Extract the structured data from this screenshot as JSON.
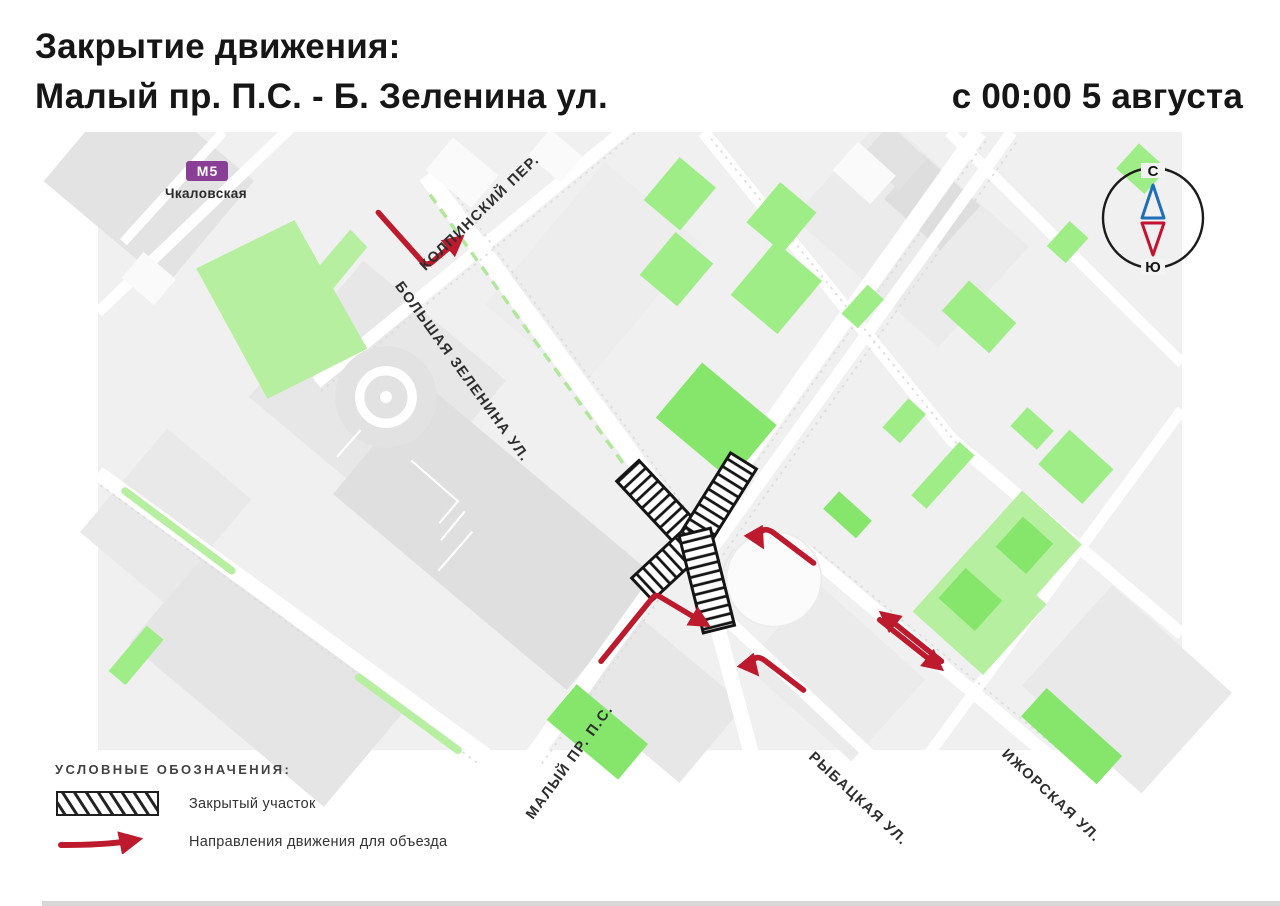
{
  "title": {
    "line1": "Закрытие движения:",
    "line2": "Малый пр. П.С. - Б. Зеленина ул.",
    "datetime": "с 00:00 5 августа"
  },
  "metro": {
    "logo": "М",
    "line_number": "5",
    "station": "Чкаловская"
  },
  "compass": {
    "north_label": "С",
    "south_label": "Ю"
  },
  "street_labels": {
    "kolpinsky": "КОЛПИНСКИЙ ПЕР.",
    "zelenina": "БОЛЬШАЯ ЗЕЛЕНИНА УЛ.",
    "maly": "МАЛЫЙ ПР. П.С.",
    "rybatskaya": "РЫБАЦКАЯ УЛ.",
    "izhorskaya": "ИЖОРСКАЯ УЛ."
  },
  "legend": {
    "header": "УСЛОВНЫЕ ОБОЗНАЧЕНИЯ:",
    "closed_label": "Закрытый участок",
    "detour_label": "Направления движения для объезда"
  },
  "colors": {
    "detour_red": "#bd1a2d",
    "metro_purple": "#8a3f96",
    "compass_north_blue": "#1e6fb8",
    "compass_south_red": "#c41230",
    "park_green": "#b6ef9f",
    "building_green": "#86e66c"
  }
}
